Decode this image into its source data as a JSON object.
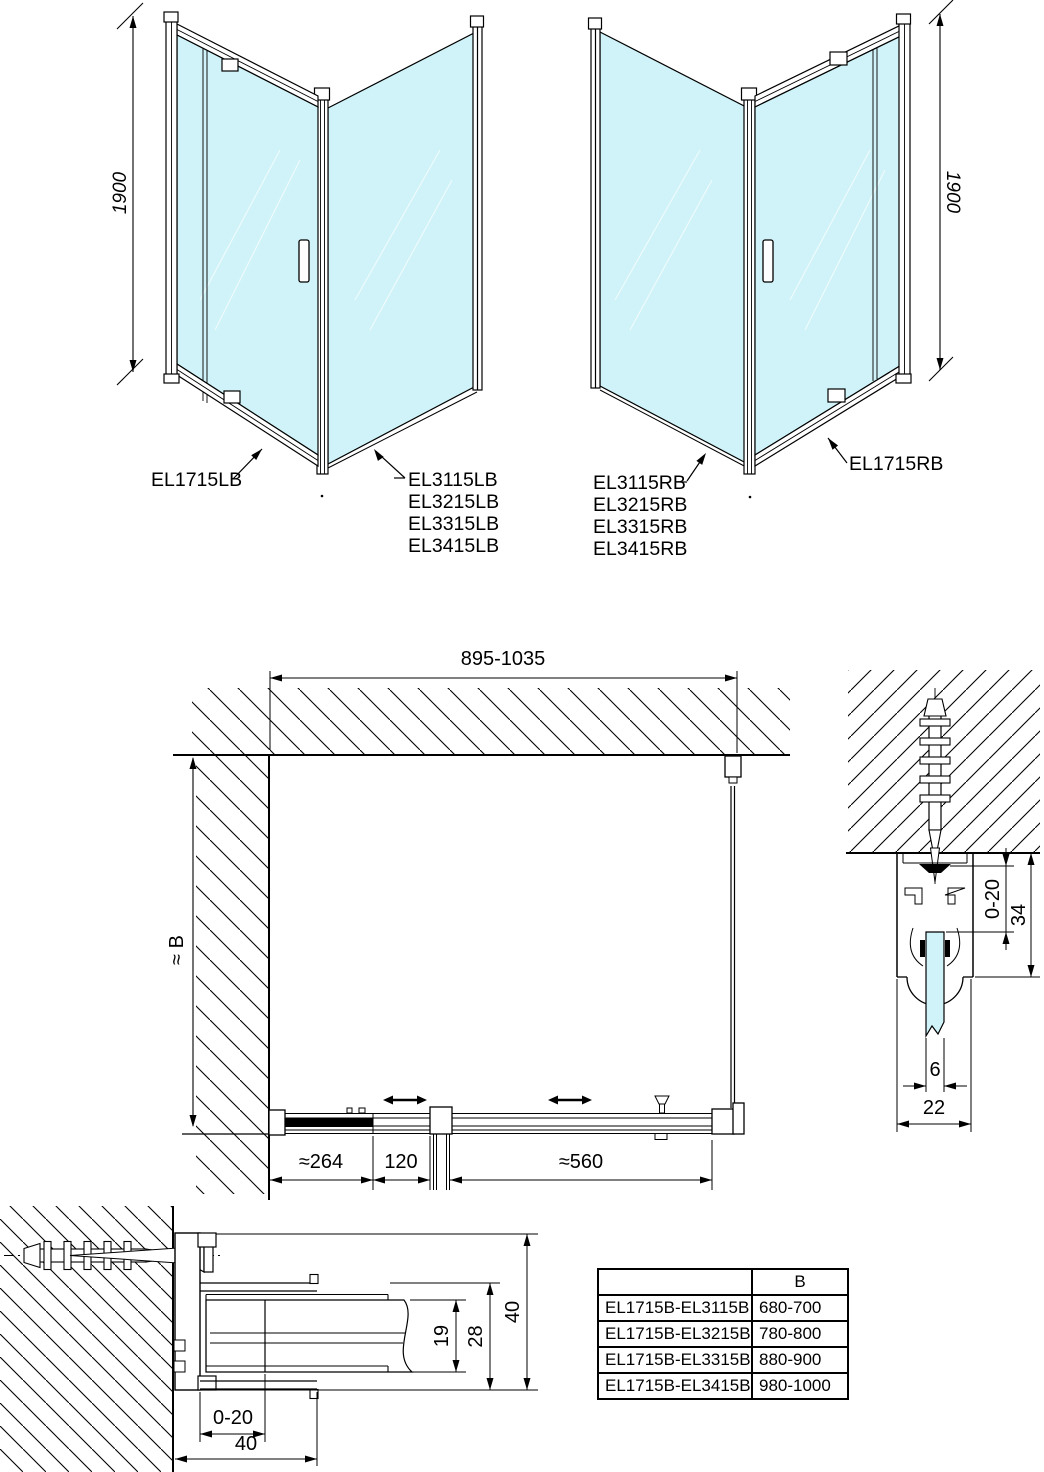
{
  "colors": {
    "glass": "#cff3f8",
    "line": "#000000"
  },
  "iso_left": {
    "height_dim": "1900",
    "door_label": "EL1715LB",
    "side_labels": [
      "EL3115LB",
      "EL3215LB",
      "EL3315LB",
      "EL3415LB"
    ]
  },
  "iso_right": {
    "height_dim": "1900",
    "door_label": "EL1715RB",
    "side_labels": [
      "EL3115RB",
      "EL3215RB",
      "EL3315RB",
      "EL3415RB"
    ]
  },
  "plan": {
    "width_dim": "895-1035",
    "depth_dim": "≈ B",
    "fixed_dim": "≈264",
    "pivot_dim": "120",
    "door_dim": "≈560"
  },
  "profile_section_top": {
    "adjust_dim": "0-20",
    "height_dim": "34",
    "glass_dim": "6",
    "width_dim": "22"
  },
  "profile_section_wall": {
    "adjust_dim": "0-20",
    "glass_channel_dim": "19",
    "frame_dim": "28",
    "total_dim": "40",
    "depth_dim": "40"
  },
  "size_table": {
    "col_b_header": "B",
    "rows": [
      {
        "combo": "EL1715B-EL3115B",
        "b": "680-700"
      },
      {
        "combo": "EL1715B-EL3215B",
        "b": "780-800"
      },
      {
        "combo": "EL1715B-EL3315B",
        "b": "880-900"
      },
      {
        "combo": "EL1715B-EL3415B",
        "b": "980-1000"
      }
    ]
  }
}
